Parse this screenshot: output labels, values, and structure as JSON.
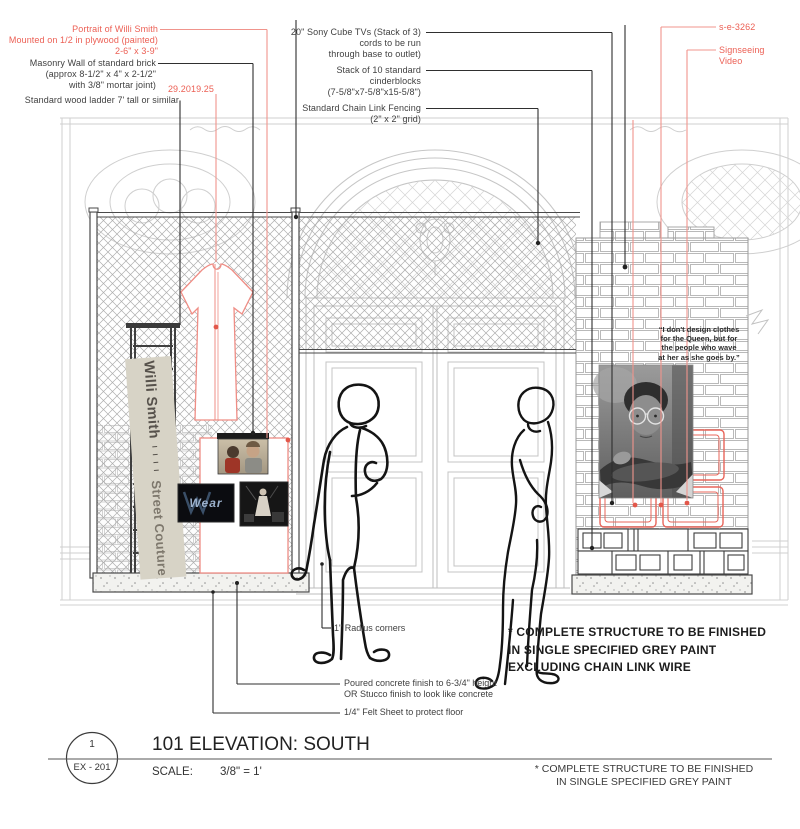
{
  "colors": {
    "annotation_red": "#ec6055",
    "leader_red": "#f0948c",
    "drawing_grey": "#cccccc",
    "structure_dark": "#3f3f3f",
    "banner_bg": "#d7d3c6"
  },
  "annotations": {
    "top_left": {
      "portrait_l1": "Portrait of Willi Smith",
      "portrait_l2": "Mounted on 1/2 in plywood (painted)",
      "portrait_l3": "2-6\" x 3-9\"",
      "masonry_l1": "Masonry Wall of standard brick",
      "masonry_l2": "(approx 8-1/2\" x 4\" x 2-1/2\"",
      "masonry_l3": "with 3/8\" mortar joint)",
      "accession": "29.2019.25",
      "ladder": "Standard wood ladder 7' tall or similar"
    },
    "top_center": {
      "tv_l1": "20\" Sony Cube TVs (Stack of 3)",
      "tv_l2": "cords to be run",
      "tv_l3": "through base to outlet)",
      "blocks_l1": "Stack of 10 standard",
      "blocks_l2": "cinderblocks",
      "blocks_l3": "(7-5/8\"x7-5/8\"x15-5/8\")",
      "fence_l1": "Standard Chain Link Fencing",
      "fence_l2": "(2\" x 2\" grid)"
    },
    "top_right": {
      "video_id": "s-e-3262",
      "video_l1": "Signseeing",
      "video_l2": "Video"
    },
    "bottom": {
      "radius": "1\" Radius corners",
      "concrete_l1": "Poured concrete finish to 6-3/4\" height",
      "concrete_l2": "OR Stucco finish to look like concrete",
      "felt": "1/4\" Felt Sheet to protect floor"
    }
  },
  "banner": {
    "line1": "Willi Smith",
    "ticks": "I I I I",
    "line2": "Street Couture"
  },
  "quote": {
    "l1": "“I don't design clothes",
    "l2": "for the Queen, but for",
    "l3": "the people who wave",
    "l4": "at her as she goes by.”"
  },
  "wear_screen_label": "Wear",
  "note_main": {
    "l1": "* COMPLETE STRUCTURE TO BE FINISHED",
    "l2": "IN SINGLE SPECIFIED GREY PAINT",
    "l3": "EXCLUDING CHAIN LINK WIRE"
  },
  "title_block": {
    "number": "1",
    "sheet": "EX - 201",
    "title": "101 ELEVATION: SOUTH",
    "scale_label": "SCALE:",
    "scale_value": "3/8\" = 1'",
    "note_l1": "* COMPLETE STRUCTURE TO BE FINISHED",
    "note_l2": "IN SINGLE SPECIFIED GREY PAINT"
  }
}
